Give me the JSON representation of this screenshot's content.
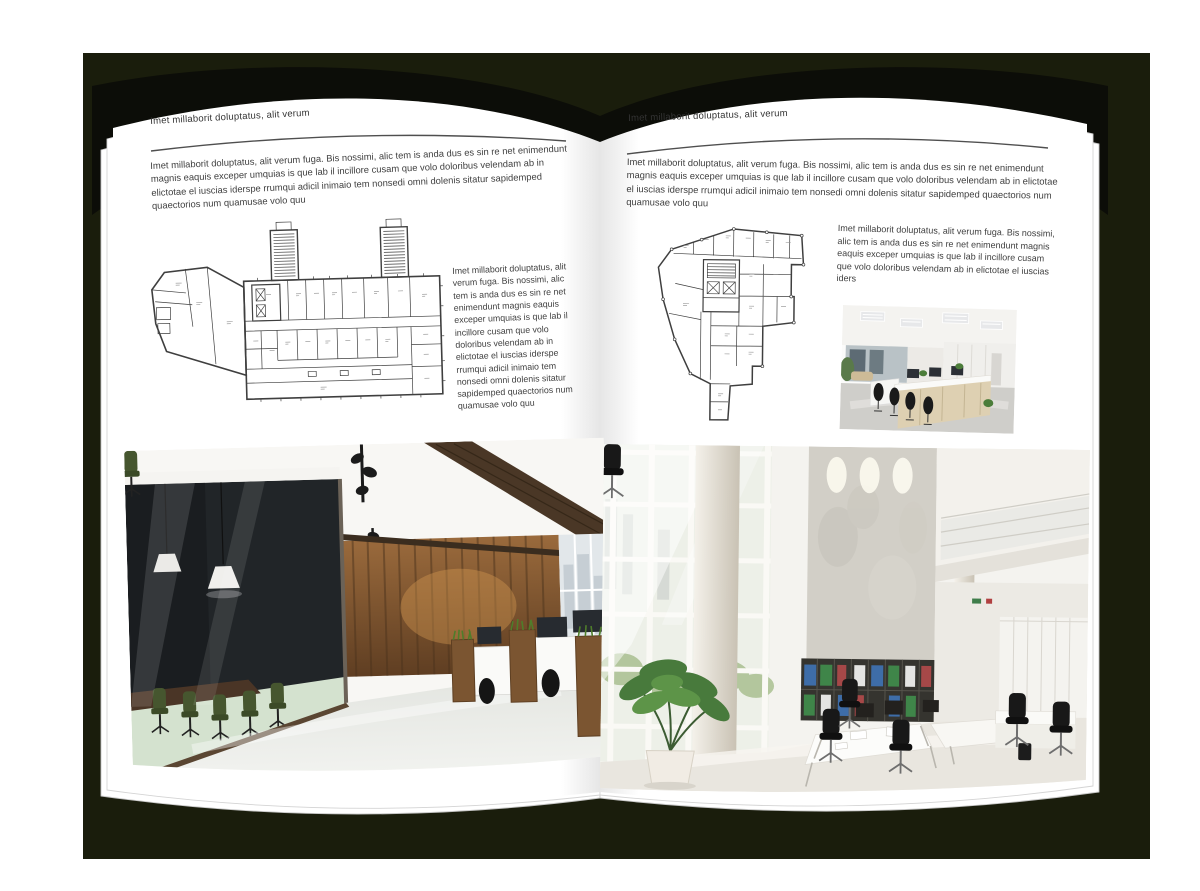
{
  "backdrop": {
    "color": "#1a1d0c"
  },
  "book": {
    "cover_color": "#0c0d08",
    "page_color": "#ffffff",
    "rule_color": "#4f4f4f"
  },
  "left_page": {
    "header": "Imet millaborit doluptatus, alit verum",
    "intro": "Imet millaborit doluptatus, alit verum fuga. Bis nossimi, alic tem is anda dus es sin re net enimendunt magnis eaquis exceper umquias is que lab il incillore cusam que volo doloribus velendam ab in elictotae el iuscias iderspe rrumqui adicil inimaio tem nonsedi omni dolenis sitatur sapidemped quaectorios num quamusae volo quu",
    "side_text": "Imet millaborit doluptatus, alit verum fuga. Bis nossimi, alic tem is anda dus es sin re net enimendunt magnis eaquis exceper umquias is que lab il incillore cusam que volo doloribus velendam ab in elictotae el iuscias iderspe rrumqui adicil inimaio tem nonsedi omni dolenis sitatur sapidemped quaectorios num quamusae volo quu"
  },
  "right_page": {
    "header": "Imet millaborit doluptatus, alit verum",
    "intro": "Imet millaborit doluptatus, alit verum fuga. Bis nossimi, alic tem is anda dus es sin re net enimendunt magnis eaquis exceper umquias is que lab il incillore cusam que volo doloribus velendam ab in elictotae el iuscias iderspe rrumqui adicil inimaio tem nonsedi omni dolenis sitatur sapidemped quaectorios num quamusae volo quu",
    "side_text": "Imet millaborit doluptatus, alit verum fuga. Bis nossimi, alic tem is anda dus es sin re net enimendunt magnis eaquis exceper umquias is que lab il incillore cusam que volo doloribus velendam ab in elictotae el iuscias iders"
  },
  "figures": {
    "left_floor_plan": "architectural floor plan",
    "right_floor_plan": "architectural floor plan",
    "left_photo": "dark wood open office interior",
    "right_photo": "white double-height office interior",
    "small_photo": "workstation row office interior"
  },
  "colors": {
    "plan_line": "#3f3f3f",
    "wood_brown": "#7b5531",
    "chair_green": "#46562f",
    "binder_blue": "#3e6da8",
    "binder_green": "#3f8549",
    "binder_red": "#a64848"
  }
}
